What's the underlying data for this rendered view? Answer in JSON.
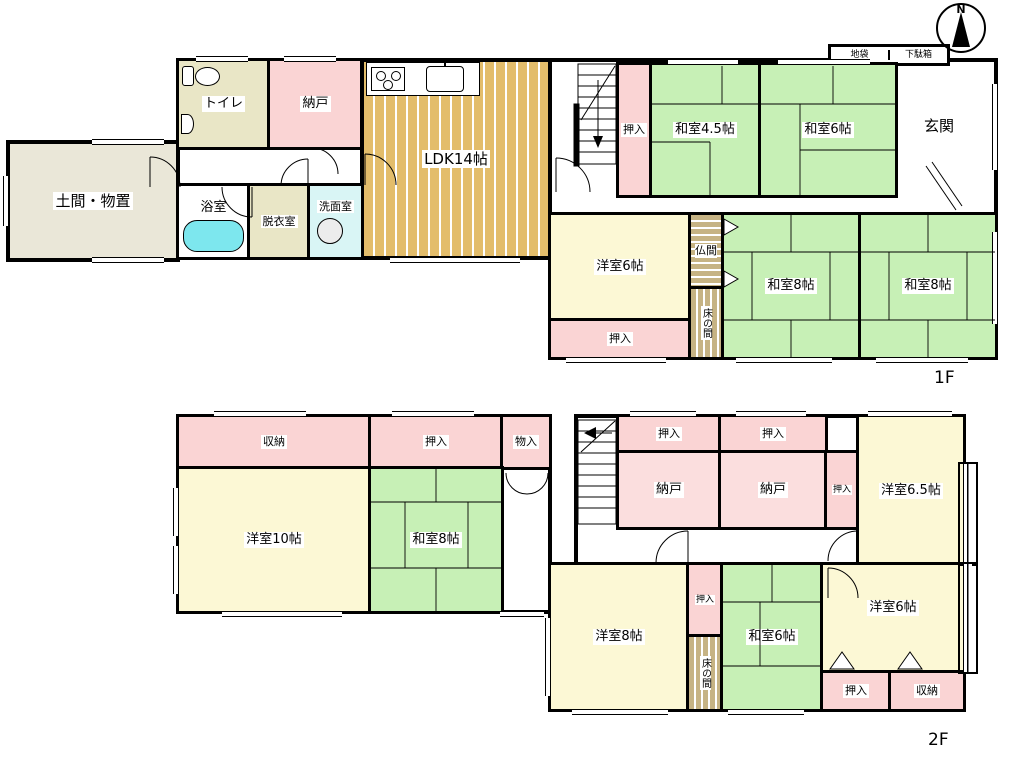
{
  "meta": {
    "compass_n": "N",
    "floor1_tag": "1F",
    "floor2_tag": "2F"
  },
  "floor1": {
    "doma": "土間・物置",
    "toilet": "トイレ",
    "nando": "納戸",
    "ldk": "LDK14帖",
    "bathroom": "浴室",
    "dressing": "脱衣室",
    "washroom": "洗面室",
    "oshiire_stair": "押入",
    "washitsu45": "和室4.5帖",
    "washitsu6": "和室6帖",
    "jibukuro": "地袋",
    "getabako": "下駄箱",
    "genkan": "玄関",
    "yoshitsu6": "洋室6帖",
    "oshiire_south": "押入",
    "butsuma": "仏間",
    "tokonoma": "床の間",
    "washitsu8_west": "和室8帖",
    "washitsu8_east": "和室8帖"
  },
  "floor2": {
    "shuno_top": "収納",
    "oshiire_top": "押入",
    "monoire": "物入",
    "yoshitsu10": "洋室10帖",
    "washitsu8": "和室8帖",
    "oshiire_a": "押入",
    "oshiire_b": "押入",
    "nando_a": "納戸",
    "nando_b": "納戸",
    "oshiire_side": "押入",
    "yoshitsu65": "洋室6.5帖",
    "yoshitsu8": "洋室8帖",
    "oshiire_small": "押入",
    "tokonoma": "床の間",
    "washitsu6": "和室6帖",
    "yoshitsu6": "洋室6帖",
    "oshiire_bottom": "押入",
    "shuno_bottom": "収納"
  }
}
